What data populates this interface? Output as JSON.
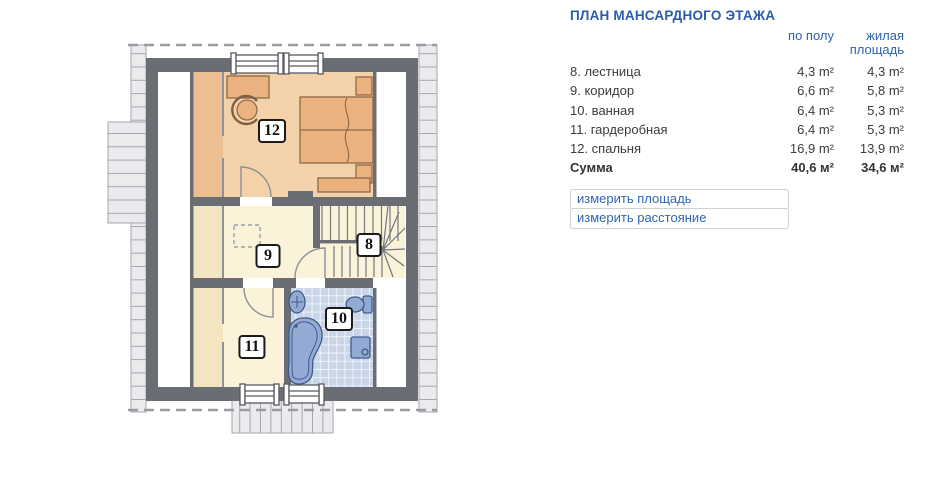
{
  "panel": {
    "title": "ПЛАН МАНСАРДНОГО ЭТАЖА",
    "columns": {
      "floor": "по полу",
      "living": "жилая площадь"
    },
    "rows": [
      {
        "name": "8. лестница",
        "floor": "4,3 m²",
        "living": "4,3 m²"
      },
      {
        "name": "9. коридор",
        "floor": "6,6 m²",
        "living": "5,8 m²"
      },
      {
        "name": "10. ванная",
        "floor": "6,4 m²",
        "living": "5,3 m²"
      },
      {
        "name": "11. гардеробная",
        "floor": "6,4 m²",
        "living": "5,3 m²"
      },
      {
        "name": "12. спальня",
        "floor": "16,9 m²",
        "living": "13,9 m²"
      }
    ],
    "total": {
      "name": "Сумма",
      "floor": "40,6 м²",
      "living": "34,6 м²"
    },
    "links": [
      {
        "label": "измерить площадь"
      },
      {
        "label": "измерить расстояние"
      }
    ],
    "accent_color": "#2b5ca9"
  },
  "plan": {
    "labels": [
      "12",
      "9",
      "8",
      "10",
      "11"
    ],
    "colors": {
      "wall": "#6a6d73",
      "bedroom_floor": "#f3d2a9",
      "low_ceiling_strip": "#ecbf92",
      "cream_floor": "#fbf2da",
      "cream_strip": "#f4e5c1",
      "bathroom_tiles": "#c9d6e8",
      "fixtures": "#93abd4",
      "furniture": "#e9b27e",
      "roof_hatch": "#ebebee"
    }
  }
}
